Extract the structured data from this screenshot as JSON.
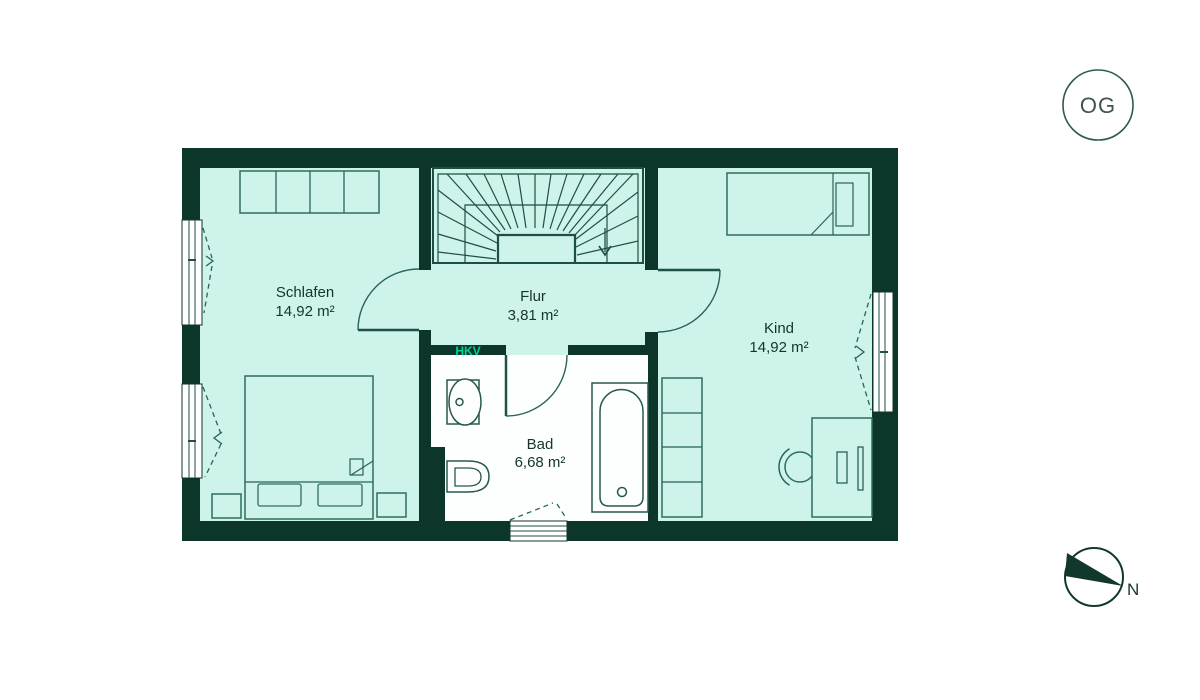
{
  "floor_badge": {
    "label": "OG"
  },
  "compass": {
    "label": "N"
  },
  "plan": {
    "technical_labels": {
      "hkv": "HKV"
    },
    "rooms": [
      {
        "name": "Schlafen",
        "area": "14,92 m²"
      },
      {
        "name": "Flur",
        "area": "3,81 m²"
      },
      {
        "name": "Kind",
        "area": "14,92 m²"
      },
      {
        "name": "Bad",
        "area": "6,68 m²"
      }
    ],
    "colors": {
      "wall": "#0d362b",
      "room_fill": "#cdf3ea",
      "wet_room_floor": "#fdfffe",
      "outline": "#2a6357",
      "accent_green": "#00d29a",
      "label_text": "#16332c"
    }
  }
}
